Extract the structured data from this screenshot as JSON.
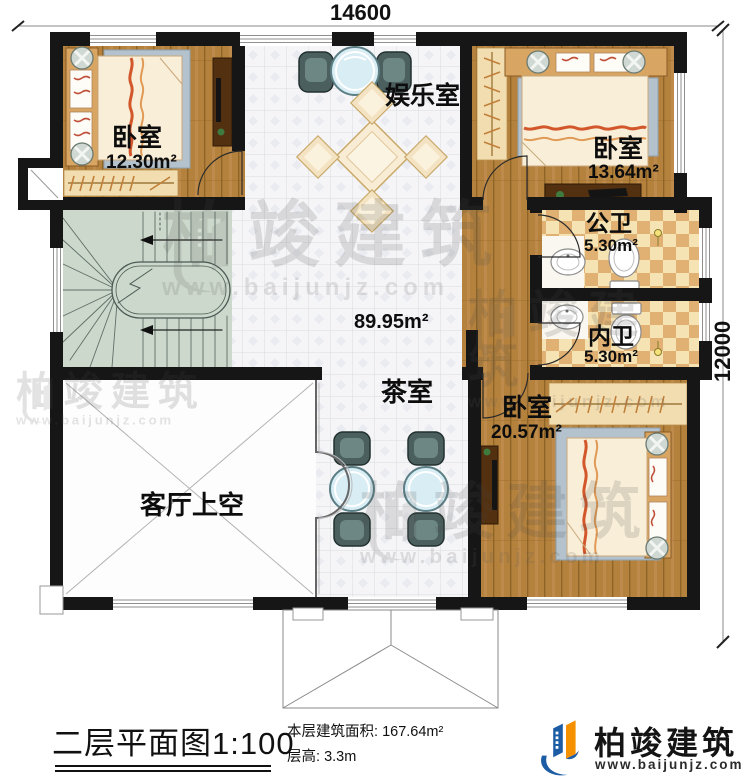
{
  "dimensions": {
    "width_top": "14600",
    "height_right": "12000"
  },
  "rooms": {
    "bedroom_tl": {
      "name": "卧室",
      "area": "12.30m²"
    },
    "entertainment": {
      "name": "娱乐室"
    },
    "bedroom_tr": {
      "name": "卧室",
      "area": "13.64m²"
    },
    "public_bath": {
      "name": "公卫",
      "area": "5.30m²"
    },
    "inner_bath": {
      "name": "内卫",
      "area": "5.30m²"
    },
    "bedroom_br": {
      "name": "卧室",
      "area": "20.57m²"
    },
    "tea_room": {
      "name": "茶室"
    },
    "hall": {
      "area": "89.95m²"
    },
    "living_void": {
      "name": "客厅上空"
    }
  },
  "footer": {
    "title": "二层平面图1:100",
    "area_label": "本层建筑面积:",
    "area_value": "167.64m²",
    "height_label": "层高:",
    "height_value": "3.3m"
  },
  "brand": {
    "name": "柏竣建筑",
    "url": "www.baijunjz.com"
  },
  "watermark": {
    "name": "柏竣建筑",
    "url": "www.baijunjz.com"
  },
  "colors": {
    "wall": "#161616",
    "wood": "#b5823e",
    "tile": "#f5f5f7",
    "stairs": "#ccd8cb",
    "checker_light": "#f6e3b4",
    "checker_dark": "#e0b173",
    "accent_blue": "#1c5ca5",
    "accent_orange": "#f59000"
  }
}
